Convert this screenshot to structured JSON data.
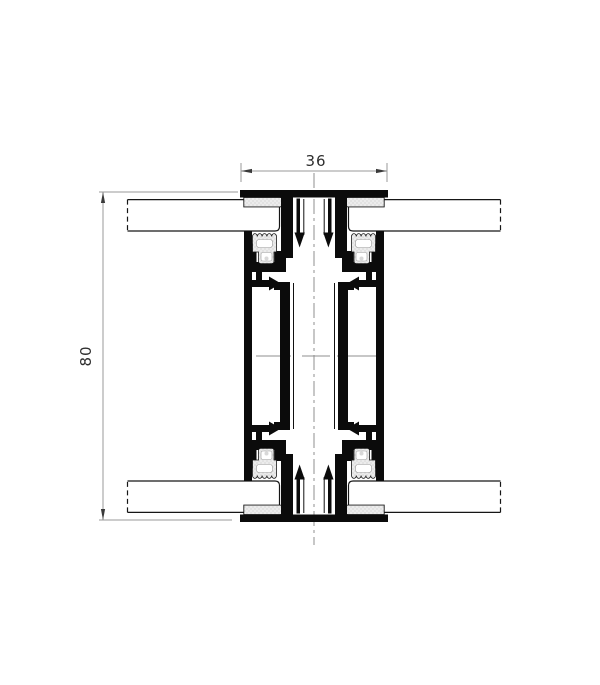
{
  "drawing": {
    "type": "aluminum-profile-cross-section",
    "dim_width_label": "36",
    "dim_height_label": "80",
    "colors": {
      "background": "#ffffff",
      "profile_outline": "#0b0b0b",
      "dimension_line": "#9a9a9a",
      "dimension_text": "#2e2e2e",
      "gasket_fill": "#ececec",
      "gasket_dot": "#b9b9b9",
      "center_line": "#8f8f8f"
    }
  }
}
